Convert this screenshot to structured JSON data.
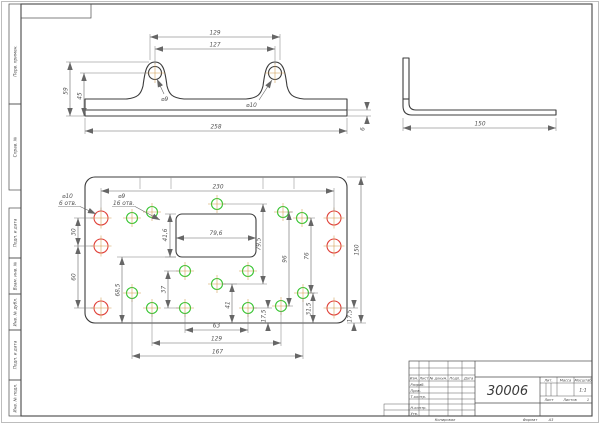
{
  "sheet": {
    "copied": "Копировал",
    "format_label": "Формат",
    "format_value": "A3"
  },
  "margin_labels": {
    "perv": "Перв. примен.",
    "sprav": "Справ. №",
    "podp1": "Подп. и дата",
    "vzam": "Взам. инв. №",
    "dubl": "Инв. № дубл.",
    "podp2": "Подп. и дата",
    "podl": "Инв. № подл."
  },
  "tb": {
    "doc_number": "30006",
    "izm": "Изм.",
    "list_col": "Лист",
    "dokum": "№ докум.",
    "podp": "Подп.",
    "data_col": "Дата",
    "razrab": "Разраб.",
    "prov": "Пров.",
    "tkontr": "Т.контр.",
    "nkontr": "Н.контр.",
    "utv": "Утв.",
    "lit": "Лит.",
    "massa": "Масса",
    "masshtab": "Масштаб",
    "scale": "1:1",
    "list": "Лист",
    "listov": "Листов",
    "listov_value": "1"
  },
  "dims": {
    "front_129": "129",
    "front_127": "127",
    "front_59": "59",
    "front_45": "45",
    "front_d9": "⌀9",
    "front_d10": "⌀10",
    "front_258": "258",
    "front_6": "6",
    "side_150": "150",
    "plan_230": "230",
    "plan_d10_label": "⌀10",
    "plan_d10_count": "6 отв.",
    "plan_d9_label": "⌀9",
    "plan_d9_count": "16 отв.",
    "plan_30": "30",
    "plan_60": "60",
    "plan_68_5": "68,5",
    "plan_41_6": "41,6",
    "plan_79_6": "79,6",
    "plan_79_5": "79,5",
    "plan_96": "96",
    "plan_76": "76",
    "plan_150": "150",
    "plan_37": "37",
    "plan_41": "41",
    "plan_17_5a": "17,5",
    "plan_31_5": "31,5",
    "plan_17_5b": "17,5",
    "plan_63": "63",
    "plan_129": "129",
    "plan_167": "167"
  },
  "front_holes": [
    [
      155,
      73
    ],
    [
      275,
      73
    ]
  ],
  "plan_holes": {
    "red": [
      [
        101,
        218
      ],
      [
        101,
        246
      ],
      [
        101,
        308
      ],
      [
        334,
        218
      ],
      [
        334,
        246
      ],
      [
        334,
        308
      ]
    ],
    "green": [
      [
        132,
        218
      ],
      [
        152,
        212
      ],
      [
        217,
        204
      ],
      [
        283,
        212
      ],
      [
        302,
        218
      ],
      [
        185,
        271
      ],
      [
        248,
        271
      ],
      [
        217,
        284
      ],
      [
        132,
        293
      ],
      [
        303,
        293
      ],
      [
        152,
        308
      ],
      [
        185,
        308
      ],
      [
        248,
        308
      ],
      [
        281,
        306
      ]
    ]
  },
  "hole_styles": {
    "red_color": "#e0423a",
    "green_color": "#35c42f",
    "center_color": "#cf9a4e",
    "outline_color": "#3c3c3c",
    "red_r": 7,
    "green_r": 5.5,
    "front_r": 6.5
  }
}
